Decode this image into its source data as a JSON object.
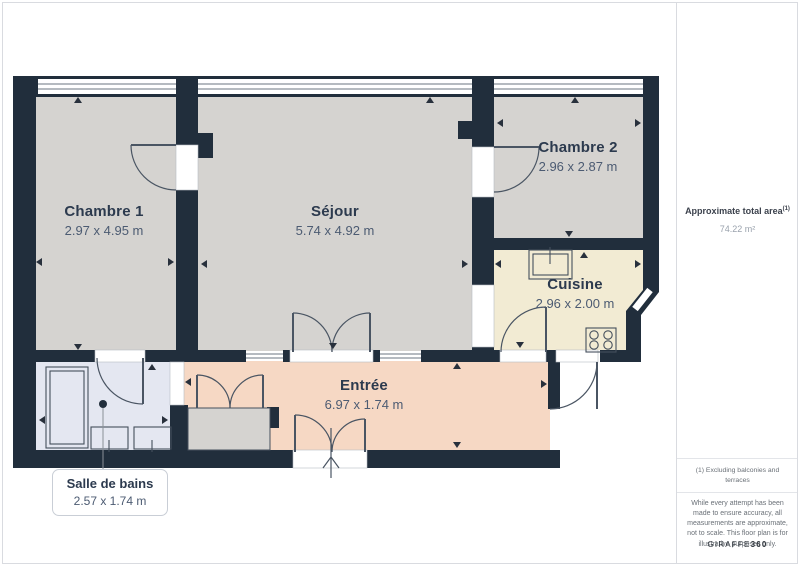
{
  "plan": {
    "rooms": [
      {
        "id": "chambre1",
        "name": "Chambre 1",
        "dims": "2.97 x 4.95 m"
      },
      {
        "id": "sejour",
        "name": "Séjour",
        "dims": "5.74 x 4.92 m"
      },
      {
        "id": "chambre2",
        "name": "Chambre 2",
        "dims": "2.96 x 2.87 m"
      },
      {
        "id": "cuisine",
        "name": "Cuisine",
        "dims": "2.96 x 2.00 m"
      },
      {
        "id": "entree",
        "name": "Entrée",
        "dims": "6.97 x 1.74 m"
      },
      {
        "id": "salle_de_bains",
        "name": "Salle de bains",
        "dims": "2.57 x 1.74 m"
      }
    ],
    "colors": {
      "wall": "#212e3c",
      "room": "#d5d3d0",
      "kitchen": "#f2ebd3",
      "entry": "#f6d8c4",
      "bath": "#e4e7f1",
      "name_text": "#2c3a4e",
      "dim_text": "#4c5b72"
    }
  },
  "sidebar": {
    "area_label": "Approximate total area",
    "area_superscript": "(1)",
    "area_value": "74.22 m²",
    "footnote": "(1) Excluding balconies and terraces",
    "disclaimer": "While every attempt has been made to ensure accuracy, all measurements are approximate, not to scale. This floor plan is for illustrative purposes only.",
    "brand_name": "GIRAFFE",
    "brand_suffix": "360"
  }
}
